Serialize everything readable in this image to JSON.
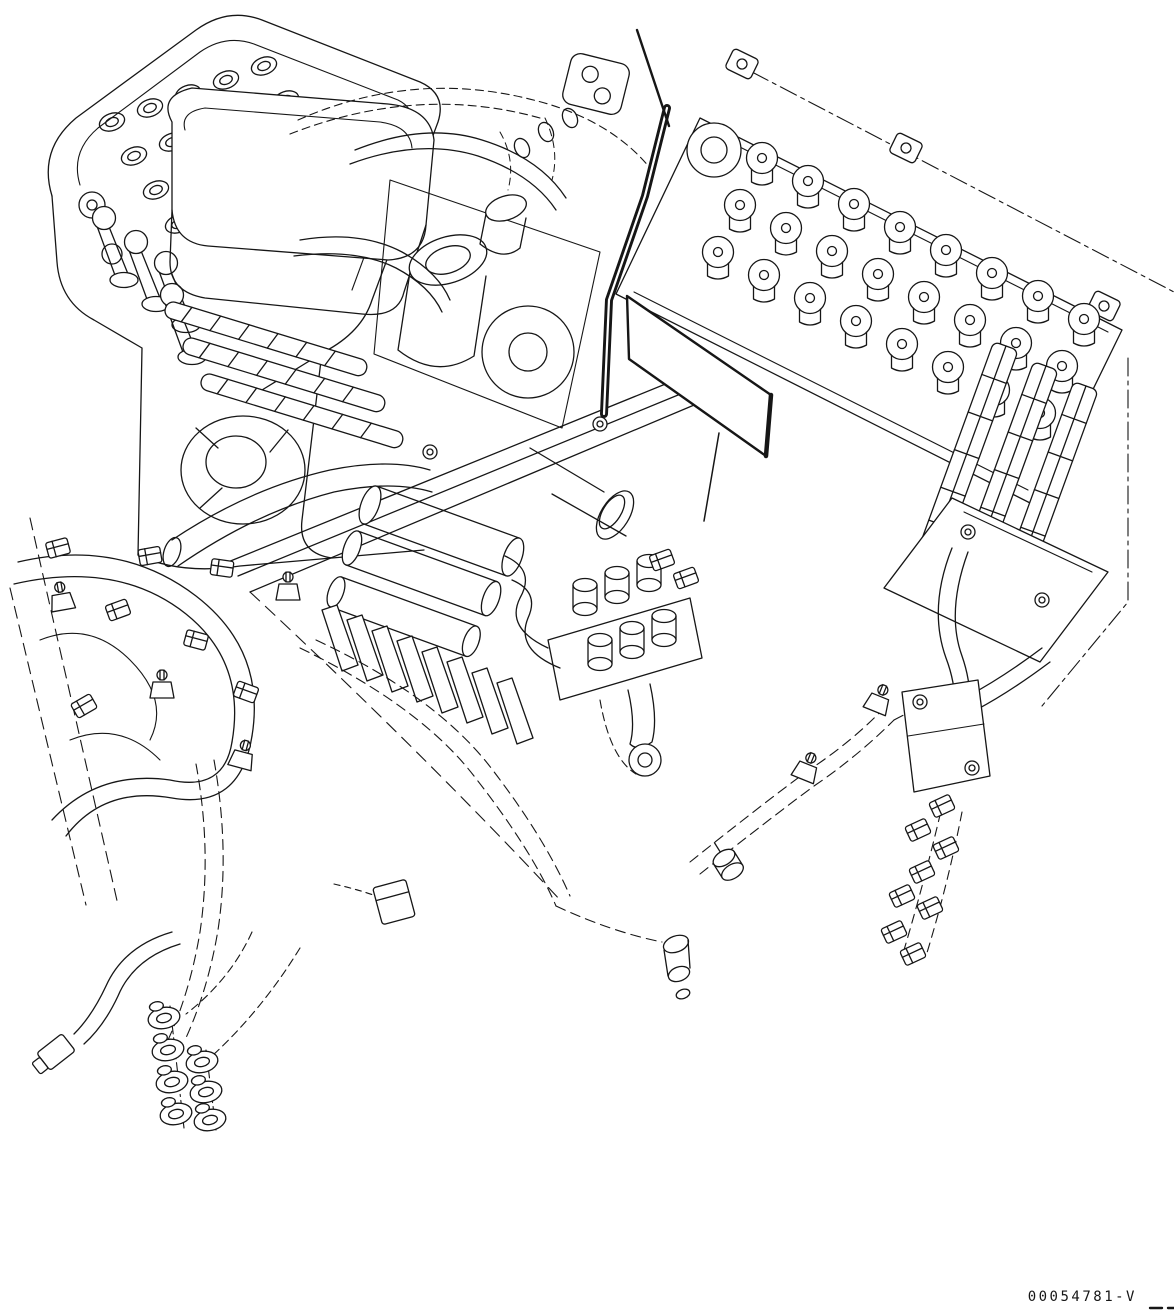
{
  "figure": {
    "drawing_number": "00054781-V"
  },
  "colors": {
    "ink": "#161616",
    "background": "#ffffff",
    "plate_fill": "#ffffff"
  }
}
